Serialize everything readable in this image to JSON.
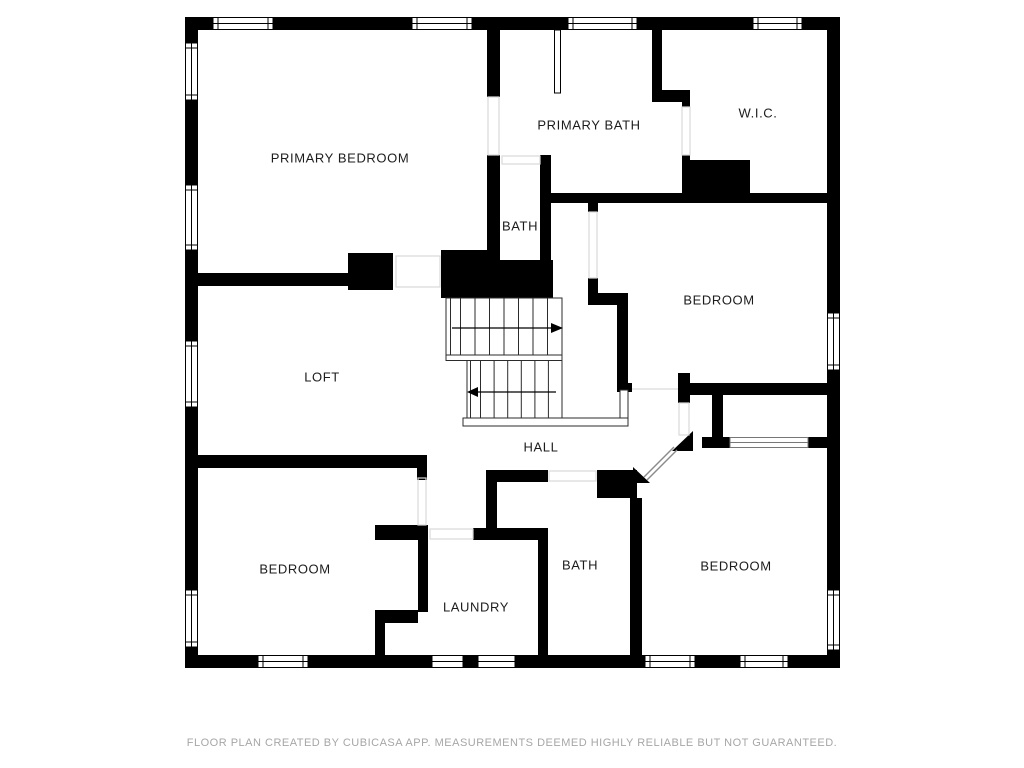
{
  "floor_plan": {
    "rooms": [
      {
        "id": "primary-bedroom",
        "label": "PRIMARY BEDROOM"
      },
      {
        "id": "primary-bath",
        "label": "PRIMARY BATH"
      },
      {
        "id": "walk-in-closet",
        "label": "W.I.C."
      },
      {
        "id": "bath-upper",
        "label": "BATH"
      },
      {
        "id": "bedroom-right",
        "label": "BEDROOM"
      },
      {
        "id": "loft",
        "label": "LOFT"
      },
      {
        "id": "hall",
        "label": "HALL"
      },
      {
        "id": "bedroom-lower-left",
        "label": "BEDROOM"
      },
      {
        "id": "bath-lower",
        "label": "BATH"
      },
      {
        "id": "laundry",
        "label": "LAUNDRY"
      },
      {
        "id": "bedroom-lower-right",
        "label": "BEDROOM"
      }
    ],
    "stairs": {
      "upper_flight_arrow": "right",
      "lower_flight_arrow": "left"
    },
    "footer": {
      "disclaimer": "FLOOR PLAN CREATED BY CUBICASA APP. MEASUREMENTS DEEMED HIGHLY RELIABLE BUT NOT GUARANTEED."
    },
    "colors": {
      "wall": "#000000",
      "background": "#ffffff",
      "room_fill": "#ffffff",
      "door_guide": "#d9d9d9",
      "label_text": "#1c1c1c",
      "footer_text": "#a6a6a6"
    }
  }
}
